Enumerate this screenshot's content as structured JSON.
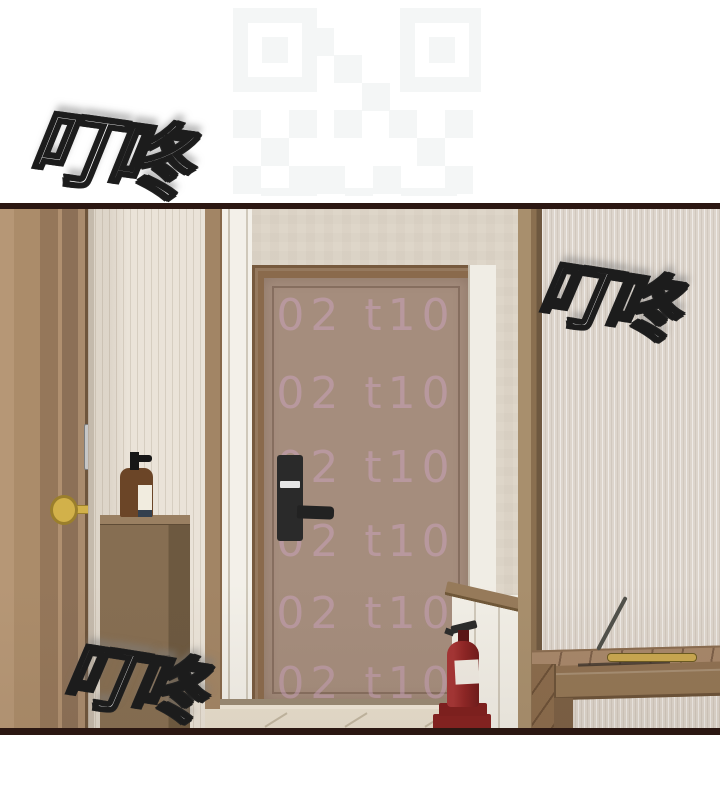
{
  "panel": {
    "type": "webtoon-comic-panel",
    "sfx": [
      {
        "id": "top-left",
        "text": "叮咚"
      },
      {
        "id": "right",
        "text": "叮咚"
      },
      {
        "id": "bottom-left",
        "text": "叮咚"
      }
    ],
    "watermark": {
      "text": "02 t10",
      "rows": 6,
      "color": "#c8a2b6"
    },
    "qr_watermark": {
      "icon": "qr-code-watermark"
    },
    "colors": {
      "page_background": "#ffffff",
      "panel_border": "#2b1712",
      "wall_beige": "#ddd4c7",
      "wallpaper_cream": "#eae3d8",
      "entrance_door": "#a58d7d",
      "door_frame": "#8a6a4c",
      "wood_door": "#b09070",
      "cabinet": "#7f684e",
      "bench": "#9c7d60",
      "fire_extinguisher": "#8e2424",
      "key_gold": "#d2b14a",
      "lock_black": "#2a2a2a",
      "floor_tile": "#e8dfce"
    },
    "objects": [
      "open-wooden-door",
      "gold-key",
      "door-latch-plate",
      "pinstripe-wallpaper",
      "shoe-cabinet",
      "soap-pump-bottle",
      "entrance-door",
      "digital-door-lock",
      "door-handle",
      "fire-extinguisher",
      "wainscot-half-wall",
      "tiled-floor",
      "wooden-bench",
      "shoehorn",
      "shoehorn-tray",
      "qr-code-watermark"
    ]
  }
}
